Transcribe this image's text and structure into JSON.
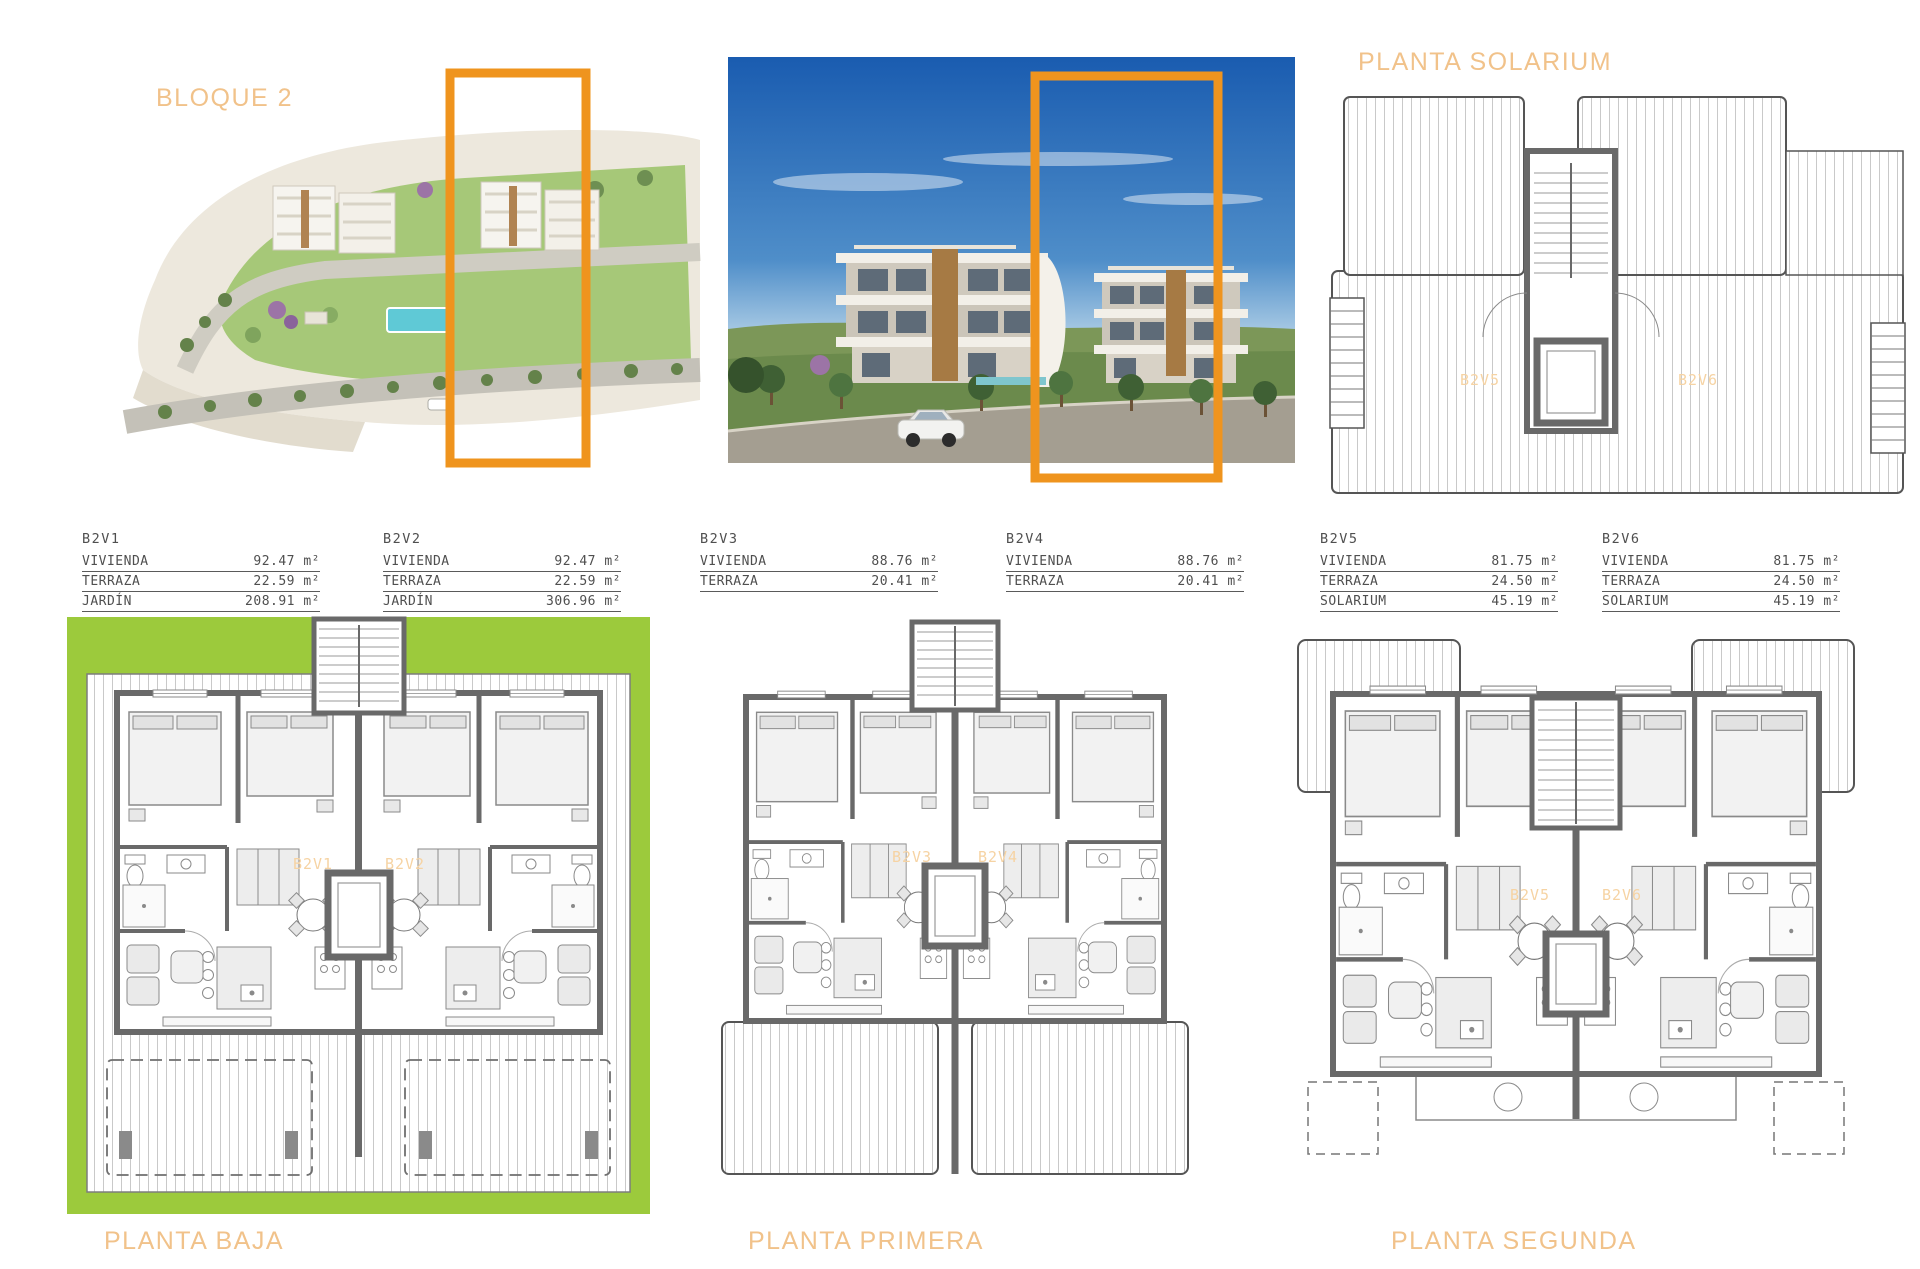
{
  "titles": {
    "bloque": "BLOQUE 2",
    "solarium": "PLANTA SOLARIUM",
    "baja": "PLANTA BAJA",
    "primera": "PLANTA PRIMERA",
    "segunda": "PLANTA SEGUNDA"
  },
  "units": [
    {
      "id": "B2V1",
      "rows": [
        {
          "label": "VIVIENDA",
          "value": "92.47 m²"
        },
        {
          "label": "TERRAZA",
          "value": "22.59 m²"
        },
        {
          "label": "JARDÍN",
          "value": "208.91 m²"
        }
      ]
    },
    {
      "id": "B2V2",
      "rows": [
        {
          "label": "VIVIENDA",
          "value": "92.47 m²"
        },
        {
          "label": "TERRAZA",
          "value": "22.59 m²"
        },
        {
          "label": "JARDÍN",
          "value": "306.96 m²"
        }
      ]
    },
    {
      "id": "B2V3",
      "rows": [
        {
          "label": "VIVIENDA",
          "value": "88.76 m²"
        },
        {
          "label": "TERRAZA",
          "value": "20.41 m²"
        }
      ]
    },
    {
      "id": "B2V4",
      "rows": [
        {
          "label": "VIVIENDA",
          "value": "88.76 m²"
        },
        {
          "label": "TERRAZA",
          "value": "20.41 m²"
        }
      ]
    },
    {
      "id": "B2V5",
      "rows": [
        {
          "label": "VIVIENDA",
          "value": "81.75 m²"
        },
        {
          "label": "TERRAZA",
          "value": "24.50 m²"
        },
        {
          "label": "SOLARIUM",
          "value": "45.19 m²"
        }
      ]
    },
    {
      "id": "B2V6",
      "rows": [
        {
          "label": "VIVIENDA",
          "value": "81.75 m²"
        },
        {
          "label": "TERRAZA",
          "value": "24.50 m²"
        },
        {
          "label": "SOLARIUM",
          "value": "45.19 m²"
        }
      ]
    }
  ],
  "plan_labels": {
    "baja": [
      "B2V1",
      "B2V2"
    ],
    "primera": [
      "B2V3",
      "B2V4"
    ],
    "segunda": [
      "B2V5",
      "B2V6"
    ],
    "solarium": [
      "B2V5",
      "B2V6"
    ]
  },
  "colors": {
    "highlight": "#EF941E",
    "title": "#F1C28A",
    "garden_green": "#9CCA3C",
    "plan_label": "#F6D3A3"
  }
}
